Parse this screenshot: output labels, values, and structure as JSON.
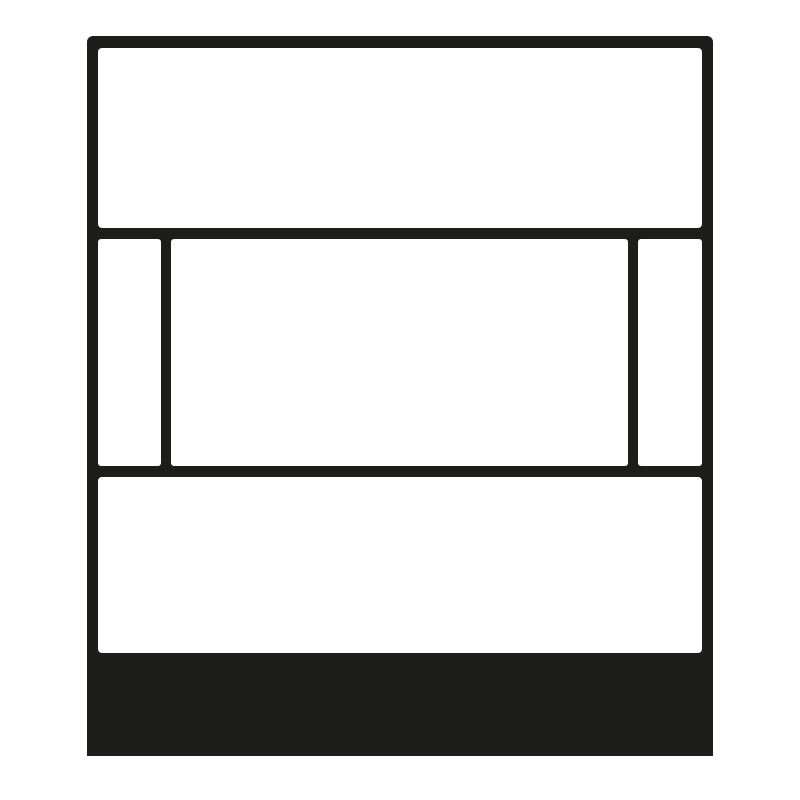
{
  "figure": {
    "type": "pictogram",
    "name": "wall-device-front-view",
    "description": "Black line-art pictogram of a rectangular wall-mounted device seen from the front: a top cover panel, a middle window band divided into three segments (narrow, wide, narrow), a bottom cover panel, and a solid dark base strip at the bottom",
    "parts": [
      {
        "name": "device-outline",
        "fill": "none",
        "stroke": "ink"
      },
      {
        "name": "top-panel",
        "fill": "paper"
      },
      {
        "name": "middle-window-left-segment",
        "fill": "paper"
      },
      {
        "name": "middle-window-center-segment",
        "fill": "paper"
      },
      {
        "name": "middle-window-right-segment",
        "fill": "paper"
      },
      {
        "name": "bottom-panel",
        "fill": "paper"
      },
      {
        "name": "base-strip",
        "fill": "ink"
      }
    ]
  },
  "colors": {
    "ink": "#1d1d1b",
    "paper": "#ffffff",
    "background": "#ffffff"
  }
}
